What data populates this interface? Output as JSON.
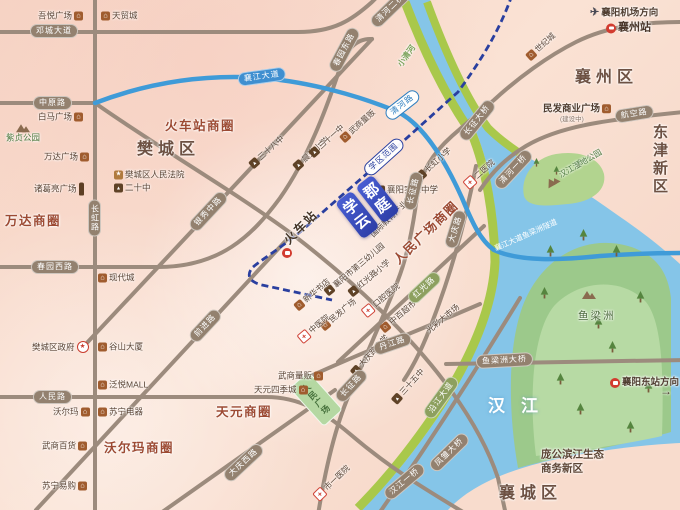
{
  "project": {
    "name": "学郡云庭",
    "logo_color": "#3a4cc4"
  },
  "park": {
    "renmin_square": "人民广场"
  },
  "colors": {
    "land": "#f7d8c9",
    "road": "#9c8b7d",
    "capsule": "#93816f",
    "water": "#85c5e8",
    "river_bank": "#a9c84b",
    "island": "#9cc98b",
    "island_inner": "#b7daa4",
    "expressway_blue": "#3f9bd8",
    "dashed_line_navy": "#2a3f9f",
    "logo_blue": "#3a4cc4",
    "district_text": "#6d5143",
    "business_circle_text": "#9c4a33"
  },
  "labels": [
    {
      "n": "dengcheng-avenue-label",
      "t": "邓城大道",
      "x": 30,
      "y": 31,
      "s": "cap"
    },
    {
      "n": "zhongyuan-road-label",
      "t": "中原路",
      "x": 33,
      "y": 103,
      "s": "cap"
    },
    {
      "n": "chunyuan-west-road-label",
      "t": "春园西路",
      "x": 31,
      "y": 267,
      "s": "cap"
    },
    {
      "n": "renmin-road-label",
      "t": "人民路",
      "x": 33,
      "y": 397,
      "s": "cap"
    },
    {
      "n": "changhong-road-label",
      "t": "长虹路",
      "x": 88,
      "y": 218,
      "s": "cap-v"
    },
    {
      "n": "chunyuan-east-road-label",
      "t": "春园东路",
      "x": 333,
      "y": 71,
      "r": -62,
      "s": "cap"
    },
    {
      "n": "yinxiu-middle-road-label",
      "t": "银秀中路",
      "x": 192,
      "y": 229,
      "r": -47,
      "s": "cap"
    },
    {
      "n": "qianjin-road-label",
      "t": "前进路",
      "x": 192,
      "y": 340,
      "r": -47,
      "s": "cap"
    },
    {
      "n": "daqing-west-road-label",
      "t": "大庆西路",
      "x": 226,
      "y": 479,
      "r": -43,
      "s": "cap"
    },
    {
      "n": "changzheng-road-south-label",
      "t": "长征路",
      "x": 338,
      "y": 400,
      "r": -47,
      "s": "cap"
    },
    {
      "n": "changzheng-road-north-label",
      "t": "长征路",
      "x": 409,
      "y": 210,
      "r": -77,
      "s": "cap"
    },
    {
      "n": "daqing-east-road-label",
      "t": "大庆路",
      "x": 450,
      "y": 248,
      "r": -73,
      "s": "cap"
    },
    {
      "n": "danjiang-road-label",
      "t": "丹江路",
      "x": 374,
      "y": 350,
      "r": -19,
      "s": "cap"
    },
    {
      "n": "hongguang-road-label",
      "t": "红光路",
      "x": 410,
      "y": 301,
      "r": -43,
      "s": "cap cap-green"
    },
    {
      "n": "yanjiang-avenue-label",
      "t": "沿江大道",
      "x": 427,
      "y": 417,
      "r": -54,
      "s": "cap cap-green"
    },
    {
      "n": "yuliangzhou-bridge-label",
      "t": "鱼梁洲大桥",
      "x": 476,
      "y": 362,
      "r": -3,
      "s": "cap"
    },
    {
      "n": "fengchu-bridge-label",
      "t": "凤雏大桥",
      "x": 432,
      "y": 469,
      "r": -44,
      "s": "cap"
    },
    {
      "n": "hanjiang-first-bridge-label",
      "t": "汉江一桥",
      "x": 386,
      "y": 497,
      "r": -40,
      "s": "cap"
    },
    {
      "n": "qinghe-first-bridge-label",
      "t": "清河一桥",
      "x": 497,
      "y": 187,
      "r": -47,
      "s": "cap"
    },
    {
      "n": "qinghe-second-bridge-label",
      "t": "清河二桥",
      "x": 373,
      "y": 25,
      "r": -44,
      "s": "cap"
    },
    {
      "n": "changzheng-bridge-label",
      "t": "长征大桥",
      "x": 462,
      "y": 139,
      "r": -51,
      "s": "cap"
    },
    {
      "n": "hangkong-road-label",
      "t": "航空路",
      "x": 615,
      "y": 117,
      "r": -9,
      "s": "cap"
    },
    {
      "n": "xiangjiang-avenue-label",
      "t": "襄江大道",
      "x": 238,
      "y": 80,
      "r": -8,
      "s": "cap cap-blue"
    },
    {
      "n": "qinghe-road-label",
      "t": "清河路",
      "x": 387,
      "y": 117,
      "r": -38,
      "s": "cap cap-blue-outline"
    },
    {
      "n": "school-district-range-label",
      "t": "学区范围",
      "x": 366,
      "y": 173,
      "r": -42,
      "s": "cap cap-navy-outline"
    },
    {
      "n": "fancheng-district-label",
      "t": "樊城区",
      "x": 137,
      "y": 150,
      "s": "district"
    },
    {
      "n": "xiangzhou-district-label",
      "t": "襄州区",
      "x": 575,
      "y": 78,
      "s": "district"
    },
    {
      "n": "xiangcheng-district-label",
      "t": "襄城区",
      "x": 499,
      "y": 494,
      "s": "district"
    },
    {
      "n": "dongjin-new-district-label",
      "t": "东津新区",
      "x": 652,
      "y": 160,
      "s": "district-v"
    },
    {
      "n": "hanjiang-river-label",
      "t": "汉江",
      "x": 488,
      "y": 406,
      "s": "river"
    },
    {
      "n": "train-station-business-circle",
      "t": "火车站商圈",
      "x": 165,
      "y": 126,
      "s": "circle"
    },
    {
      "n": "wanda-business-circle",
      "t": "万达商圈",
      "x": 5,
      "y": 221,
      "s": "circle"
    },
    {
      "n": "walmart-business-circle",
      "t": "沃尔玛商圈",
      "x": 104,
      "y": 448,
      "s": "circle"
    },
    {
      "n": "tianyuan-business-circle",
      "t": "天元商圈",
      "x": 216,
      "y": 412,
      "s": "circle"
    },
    {
      "n": "renmin-square-business-circle",
      "t": "人民广场商圈",
      "x": 396,
      "y": 262,
      "r": -44,
      "s": "circle"
    },
    {
      "n": "pangong-riverside-new-area",
      "t": "庞公滨江生态商务新区",
      "x": 541,
      "y": 462,
      "s": "wrap64"
    },
    {
      "n": "poi-wuyue-plaza",
      "t": "吾悦广场",
      "x": 38,
      "y": 16,
      "ic": "shop",
      "ip": "r"
    },
    {
      "n": "poi-tianmao-city",
      "t": "天贸城",
      "x": 101,
      "y": 16,
      "ic": "shop"
    },
    {
      "n": "poi-baima-plaza",
      "t": "白马广场",
      "x": 38,
      "y": 117,
      "ic": "shop",
      "ip": "r"
    },
    {
      "n": "poi-zizhen-park",
      "t": "紫贞公园",
      "x": 6,
      "y": 132,
      "ic": "park",
      "ip": "t",
      "s": "col green-text"
    },
    {
      "n": "poi-wanda-plaza",
      "t": "万达广场",
      "x": 44,
      "y": 157,
      "ic": "shop",
      "ip": "r"
    },
    {
      "n": "poi-zhugeliang-square",
      "t": "诸葛亮广场",
      "x": 34,
      "y": 189,
      "ic": "statue",
      "ip": "r"
    },
    {
      "n": "poi-fancheng-court",
      "t": "樊城区人民法院",
      "x": 114,
      "y": 175,
      "ic": "star"
    },
    {
      "n": "poi-no20-middle-school",
      "t": "二十中",
      "x": 114,
      "y": 188,
      "ic": "school"
    },
    {
      "n": "poi-xiandai-city",
      "t": "现代城",
      "x": 98,
      "y": 278,
      "ic": "shop"
    },
    {
      "n": "poi-fancheng-government",
      "t": "樊城区政府",
      "x": 32,
      "y": 347,
      "ic": "gov",
      "ip": "r"
    },
    {
      "n": "poi-gushan-tower",
      "t": "谷山大厦",
      "x": 98,
      "y": 347,
      "ic": "shop"
    },
    {
      "n": "poi-fanyue-mall",
      "t": "泛悦MALL",
      "x": 98,
      "y": 385,
      "ic": "shop"
    },
    {
      "n": "poi-walmart",
      "t": "沃尔玛",
      "x": 53,
      "y": 412,
      "ic": "shop",
      "ip": "r"
    },
    {
      "n": "poi-suning-appliance",
      "t": "苏宁电器",
      "x": 98,
      "y": 412,
      "ic": "shop"
    },
    {
      "n": "poi-wushang-department-store",
      "t": "武商百货",
      "x": 42,
      "y": 446,
      "ic": "shop",
      "ip": "r"
    },
    {
      "n": "poi-suning-store",
      "t": "苏宁易购",
      "x": 42,
      "y": 486,
      "ic": "shop",
      "ip": "r"
    },
    {
      "n": "poi-wushang-mart-south",
      "t": "武商量贩",
      "x": 278,
      "y": 376,
      "ic": "shop",
      "ip": "r"
    },
    {
      "n": "poi-tianyuan-four-seasons",
      "t": "天元四季城",
      "x": 254,
      "y": 390,
      "ic": "shop",
      "ip": "r"
    },
    {
      "n": "poi-minfa-commercial-plaza",
      "t": "民发商业广场",
      "x": 543,
      "y": 109,
      "ic": "shop",
      "ip": "r",
      "s": "poi-md"
    },
    {
      "n": "minfa-plaza-note",
      "t": "(建设中)",
      "x": 560,
      "y": 120,
      "s": "subtext"
    },
    {
      "n": "xiangyang-airport-direction",
      "t": "襄阳机场方向",
      "x": 590,
      "y": 13,
      "ic": "plane",
      "s": "poi-md"
    },
    {
      "n": "poi-xiangzhou-station",
      "t": "襄州站",
      "x": 606,
      "y": 28,
      "ic": "train",
      "s": "station"
    },
    {
      "n": "xiangyang-east-station-direction",
      "t": "襄阳东站方向",
      "x": 610,
      "y": 383,
      "ic": "train",
      "s": "poi-md"
    },
    {
      "n": "east-station-arrow",
      "t": "→",
      "x": 660,
      "y": 391,
      "s": "arrow"
    },
    {
      "n": "poi-experimental-middle-school",
      "t": "襄阳实验中学",
      "x": 376,
      "y": 190,
      "ic": "school"
    },
    {
      "n": "railway-station-label",
      "t": "火车站",
      "x": 286,
      "y": 242,
      "r": -45,
      "s": "station-big"
    },
    {
      "n": "railway-station-icon",
      "t": "",
      "x": 282,
      "y": 253,
      "ic": "train"
    },
    {
      "n": "poi-no38-middle-school",
      "t": "三十八中",
      "x": 251,
      "y": 166,
      "r": -42,
      "ic": "school",
      "s": "poi-rot"
    },
    {
      "n": "poi-chenguang-primary",
      "t": "晨光小学",
      "x": 295,
      "y": 168,
      "r": -42,
      "ic": "school",
      "s": "poi-rot"
    },
    {
      "n": "poi-no31-middle-school",
      "t": "三十一中",
      "x": 311,
      "y": 155,
      "r": -42,
      "ic": "school",
      "s": "poi-rot"
    },
    {
      "n": "poi-wushang-mart-north",
      "t": "武商量贩",
      "x": 342,
      "y": 140,
      "r": -42,
      "ic": "shop",
      "s": "poi-rot"
    },
    {
      "n": "poi-changhong-primary",
      "t": "长虹小学",
      "x": 418,
      "y": 178,
      "r": -42,
      "ic": "school",
      "s": "poi-rot"
    },
    {
      "n": "poi-intl-education-park",
      "t": "国际教育产业园",
      "x": 372,
      "y": 236,
      "r": -44,
      "s": "poi-rot"
    },
    {
      "n": "poi-no2-hospital",
      "t": "二医院",
      "x": 466,
      "y": 186,
      "r": -42,
      "ic": "cross",
      "s": "poi-rot"
    },
    {
      "n": "poi-third-kindergarten",
      "t": "襄阳市第三幼儿园",
      "x": 326,
      "y": 293,
      "r": -40,
      "ic": "school",
      "s": "poi-rot"
    },
    {
      "n": "poi-hongguang-primary",
      "t": "红光路小学",
      "x": 350,
      "y": 294,
      "r": -40,
      "ic": "school",
      "s": "poi-rot"
    },
    {
      "n": "poi-xinhua-bookstore",
      "t": "新华书店",
      "x": 296,
      "y": 308,
      "r": -40,
      "ic": "shop",
      "s": "poi-rot"
    },
    {
      "n": "poi-minfa-plaza",
      "t": "民发广场",
      "x": 322,
      "y": 328,
      "r": -40,
      "ic": "shop",
      "s": "poi-rot"
    },
    {
      "n": "poi-stomatological-hospital",
      "t": "口腔医院",
      "x": 364,
      "y": 314,
      "r": -40,
      "ic": "cross",
      "s": "poi-rot"
    },
    {
      "n": "poi-tcm-hospital",
      "t": "中医院",
      "x": 300,
      "y": 340,
      "r": -40,
      "ic": "cross",
      "s": "poi-rot"
    },
    {
      "n": "poi-zhongbai-supermarket",
      "t": "中百超市",
      "x": 382,
      "y": 330,
      "r": -40,
      "ic": "shop",
      "s": "poi-rot"
    },
    {
      "n": "poi-guangcai-market",
      "t": "光彩大市场",
      "x": 428,
      "y": 332,
      "r": -40,
      "s": "poi-rot"
    },
    {
      "n": "poi-daqing-road-primary",
      "t": "大庆路小学",
      "x": 353,
      "y": 374,
      "r": -48,
      "ic": "school",
      "s": "poi-rot"
    },
    {
      "n": "poi-no35-middle-school",
      "t": "三十五中",
      "x": 394,
      "y": 402,
      "r": -48,
      "ic": "school",
      "s": "poi-rot"
    },
    {
      "n": "poi-no1-hospital",
      "t": "市一医院",
      "x": 316,
      "y": 498,
      "r": -44,
      "ic": "cross",
      "s": "poi-rot"
    },
    {
      "n": "poi-century-city",
      "t": "世纪城",
      "x": 528,
      "y": 58,
      "r": -42,
      "ic": "shop",
      "s": "poi-rot"
    },
    {
      "n": "poi-hanjiang-wetland-park",
      "t": "汉江湿地公园",
      "x": 546,
      "y": 184,
      "r": -30,
      "ic": "park",
      "s": "poi-rot green-text"
    },
    {
      "n": "xiaoqinghe-river-label",
      "t": "小清河",
      "x": 400,
      "y": 66,
      "r": -55,
      "s": "green-rot"
    },
    {
      "n": "yuliangzhou-island-label",
      "t": "鱼梁洲",
      "x": 578,
      "y": 316,
      "s": "poi-green-md"
    },
    {
      "n": "yuliangzhou-island-icon",
      "t": "",
      "x": 582,
      "y": 294,
      "ic": "park"
    },
    {
      "n": "tunnel-label",
      "t": "襄江大道鱼梁洲隧道",
      "x": 495,
      "y": 249,
      "r": -24,
      "s": "tunnel"
    }
  ]
}
